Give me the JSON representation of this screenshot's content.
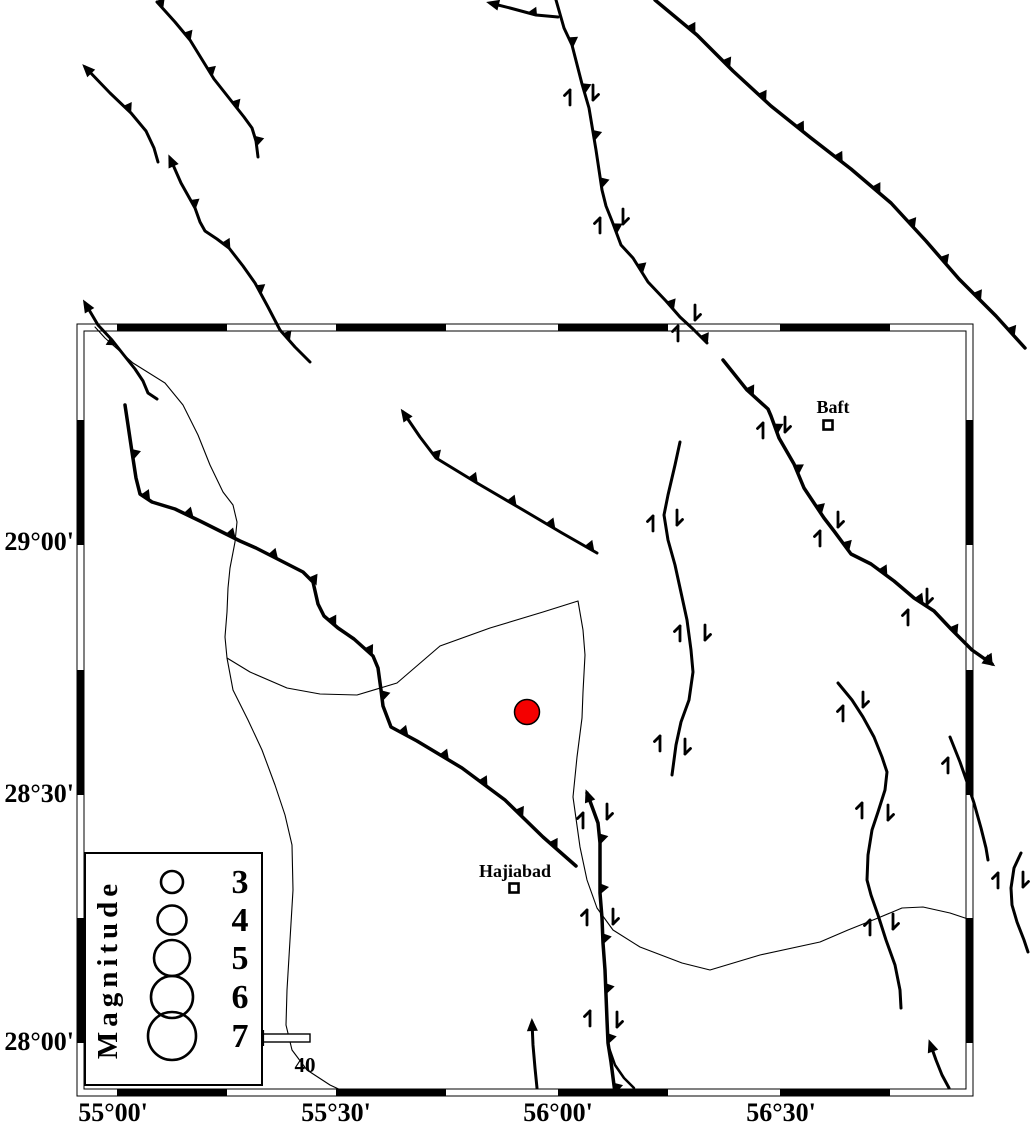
{
  "canvas": {
    "width": 1030,
    "height": 1127,
    "background": "#ffffff",
    "ink": "#000000"
  },
  "frame": {
    "outer": [
      77,
      324,
      973,
      1096
    ],
    "inner": [
      84,
      331,
      966,
      1089
    ],
    "band": 7,
    "x_black_segments": [
      [
        117,
        227
      ],
      [
        336,
        446
      ],
      [
        558,
        668
      ],
      [
        780,
        890
      ]
    ],
    "y_black_segments": [
      [
        420,
        545
      ],
      [
        670,
        795
      ],
      [
        918,
        1043
      ]
    ]
  },
  "axis": {
    "lat_labels": [
      {
        "text": "29°00'",
        "x": 74,
        "y": 550
      },
      {
        "text": "28°30'",
        "x": 74,
        "y": 802
      },
      {
        "text": "28°00'",
        "x": 74,
        "y": 1050
      }
    ],
    "lon_labels": [
      {
        "text": "55°00'",
        "x": 113,
        "y": 1121
      },
      {
        "text": "55°30'",
        "x": 336,
        "y": 1121
      },
      {
        "text": "56°00'",
        "x": 558,
        "y": 1121
      },
      {
        "text": "56°30'",
        "x": 781,
        "y": 1121
      }
    ]
  },
  "cities": [
    {
      "name": "Baft",
      "label_x": 833,
      "label_y": 413,
      "marker_x": 828,
      "marker_y": 425
    },
    {
      "name": "Hajiabad",
      "label_x": 515,
      "label_y": 877,
      "marker_x": 514,
      "marker_y": 888
    }
  ],
  "epicenter": {
    "x": 527,
    "y": 712,
    "r": 12.5,
    "color": "#f40000"
  },
  "legend": {
    "box": [
      85,
      853,
      262,
      1085
    ],
    "title": "Magnitude",
    "title_x": 117,
    "title_y": 969,
    "circle_cx": 172,
    "label_x": 240,
    "entries": [
      {
        "label": "3",
        "cy": 882,
        "r": 11
      },
      {
        "label": "4",
        "cy": 920,
        "r": 14.5
      },
      {
        "label": "5",
        "cy": 958,
        "r": 18
      },
      {
        "label": "6",
        "cy": 997,
        "r": 21
      },
      {
        "label": "7",
        "cy": 1036,
        "r": 24
      }
    ]
  },
  "scalebar": {
    "x1": 263,
    "x2": 310,
    "y": 1034,
    "h": 8,
    "label": "40",
    "label_x": 305,
    "label_y": 1072
  },
  "rivers": [
    {
      "points": [
        [
          95,
          327
        ],
        [
          105,
          338
        ],
        [
          133,
          363
        ],
        [
          165,
          383
        ],
        [
          183,
          405
        ],
        [
          198,
          435
        ],
        [
          210,
          465
        ],
        [
          223,
          492
        ],
        [
          233,
          505
        ],
        [
          237,
          522
        ],
        [
          235,
          542
        ],
        [
          230,
          568
        ],
        [
          228,
          588
        ],
        [
          227,
          612
        ],
        [
          225,
          637
        ],
        [
          227,
          658
        ]
      ]
    },
    {
      "points": [
        [
          227,
          658
        ],
        [
          250,
          672
        ],
        [
          287,
          688
        ],
        [
          320,
          694
        ],
        [
          357,
          695
        ],
        [
          397,
          683
        ],
        [
          440,
          646
        ],
        [
          490,
          628
        ],
        [
          543,
          612
        ],
        [
          578,
          601
        ],
        [
          583,
          630
        ],
        [
          585,
          655
        ],
        [
          583,
          692
        ],
        [
          582,
          718
        ],
        [
          577,
          757
        ],
        [
          573,
          797
        ],
        [
          580,
          847
        ],
        [
          587,
          880
        ],
        [
          597,
          908
        ],
        [
          613,
          930
        ],
        [
          640,
          947
        ],
        [
          682,
          963
        ],
        [
          710,
          970
        ],
        [
          760,
          955
        ],
        [
          820,
          942
        ],
        [
          848,
          930
        ],
        [
          878,
          918
        ],
        [
          902,
          908
        ],
        [
          923,
          907
        ],
        [
          950,
          913
        ],
        [
          968,
          919
        ]
      ]
    },
    {
      "points": [
        [
          227,
          658
        ],
        [
          233,
          690
        ],
        [
          248,
          720
        ],
        [
          262,
          750
        ],
        [
          275,
          785
        ],
        [
          285,
          815
        ],
        [
          292,
          845
        ],
        [
          293,
          890
        ],
        [
          290,
          940
        ],
        [
          287,
          990
        ],
        [
          286,
          1025
        ],
        [
          292,
          1050
        ],
        [
          307,
          1070
        ],
        [
          330,
          1085
        ],
        [
          345,
          1092
        ]
      ]
    }
  ],
  "faults": [
    {
      "id": "f-nw-1",
      "lw": 3,
      "points": [
        [
          157,
          2
        ],
        [
          175,
          22
        ],
        [
          190,
          40
        ],
        [
          214,
          79
        ],
        [
          244,
          117
        ],
        [
          252,
          128
        ],
        [
          256,
          141
        ],
        [
          258,
          157
        ]
      ],
      "teeth": {
        "interval": 42,
        "size": 8.5,
        "side": 1,
        "start": 4
      }
    },
    {
      "id": "f-nw-2",
      "lw": 3,
      "start_arrow": true,
      "points": [
        [
          85,
          67
        ],
        [
          110,
          93
        ],
        [
          131,
          113
        ],
        [
          146,
          131
        ],
        [
          154,
          148
        ],
        [
          158,
          162
        ]
      ],
      "teeth": {
        "interval": 150,
        "size": 8.5,
        "side": 1,
        "start": 60
      }
    },
    {
      "id": "f-nw-3",
      "lw": 3,
      "start_arrow": true,
      "points": [
        [
          170,
          158
        ],
        [
          181,
          183
        ],
        [
          195,
          208
        ],
        [
          200,
          222
        ],
        [
          205,
          231
        ],
        [
          217,
          239
        ],
        [
          229,
          248
        ],
        [
          243,
          266
        ],
        [
          255,
          283
        ],
        [
          268,
          307
        ],
        [
          280,
          330
        ],
        [
          295,
          347
        ],
        [
          310,
          362
        ]
      ],
      "teeth": {
        "interval": 55,
        "size": 8.5,
        "side": 1,
        "start": 52
      }
    },
    {
      "id": "f-frame-w",
      "lw": 3,
      "start_arrow": true,
      "points": [
        [
          85,
          303
        ],
        [
          98,
          325
        ],
        [
          112,
          340
        ],
        [
          123,
          354
        ],
        [
          135,
          369
        ],
        [
          143,
          381
        ],
        [
          148,
          393
        ],
        [
          157,
          399
        ]
      ],
      "teeth": {
        "interval": 90,
        "size": 8,
        "side": -1,
        "start": 48
      }
    },
    {
      "id": "f-central",
      "lw": 3,
      "points": [
        [
          556,
          0
        ],
        [
          564,
          28
        ],
        [
          572,
          45
        ],
        [
          582,
          84
        ],
        [
          589,
          108
        ],
        [
          596,
          150
        ],
        [
          602,
          190
        ],
        [
          606,
          206
        ],
        [
          612,
          221
        ],
        [
          621,
          245
        ],
        [
          633,
          258
        ],
        [
          648,
          282
        ],
        [
          666,
          301
        ],
        [
          680,
          317
        ],
        [
          693,
          329
        ],
        [
          707,
          343
        ]
      ],
      "teeth": {
        "interval": 48,
        "size": 9,
        "side": 1,
        "start": 45
      }
    },
    {
      "id": "f-central-branch",
      "lw": 3,
      "end_arrow": true,
      "points": [
        [
          558,
          17
        ],
        [
          536,
          15
        ],
        [
          510,
          8
        ],
        [
          490,
          3
        ]
      ],
      "teeth": {
        "interval": 120,
        "size": 8,
        "side": -1,
        "start": 26
      }
    },
    {
      "id": "f-ne",
      "lw": 3.5,
      "points": [
        [
          655,
          0
        ],
        [
          697,
          35
        ],
        [
          733,
          71
        ],
        [
          771,
          106
        ],
        [
          811,
          138
        ],
        [
          851,
          169
        ],
        [
          891,
          203
        ],
        [
          926,
          241
        ],
        [
          959,
          279
        ],
        [
          996,
          316
        ],
        [
          1025,
          348
        ]
      ],
      "teeth": {
        "interval": 49,
        "size": 9,
        "side": 1,
        "start": 47
      }
    },
    {
      "id": "f-main-thrust",
      "lw": 3.5,
      "points": [
        [
          125,
          405
        ],
        [
          128,
          425
        ],
        [
          132,
          452
        ],
        [
          136,
          478
        ],
        [
          140,
          494
        ],
        [
          152,
          502
        ],
        [
          175,
          509
        ],
        [
          200,
          521
        ],
        [
          240,
          541
        ],
        [
          256,
          548
        ],
        [
          303,
          572
        ],
        [
          313,
          582
        ],
        [
          318,
          604
        ],
        [
          324,
          616
        ],
        [
          338,
          628
        ],
        [
          354,
          639
        ],
        [
          373,
          656
        ],
        [
          378,
          668
        ],
        [
          381,
          690
        ],
        [
          383,
          706
        ],
        [
          391,
          727
        ],
        [
          417,
          741
        ],
        [
          462,
          768
        ],
        [
          505,
          800
        ],
        [
          543,
          837
        ],
        [
          576,
          866
        ]
      ],
      "teeth": {
        "interval": 47,
        "size": 9,
        "side": 1,
        "start": 50
      }
    },
    {
      "id": "f-mid",
      "lw": 3,
      "start_arrow": true,
      "points": [
        [
          403,
          412
        ],
        [
          420,
          437
        ],
        [
          436,
          458
        ],
        [
          477,
          483
        ],
        [
          518,
          507
        ],
        [
          562,
          533
        ],
        [
          597,
          553
        ]
      ],
      "teeth": {
        "interval": 45,
        "size": 9,
        "side": 1,
        "start": 55
      }
    },
    {
      "id": "f-baft",
      "lw": 3.5,
      "end_arrow": true,
      "points": [
        [
          723,
          360
        ],
        [
          747,
          390
        ],
        [
          768,
          409
        ],
        [
          771,
          416
        ],
        [
          779,
          438
        ],
        [
          794,
          464
        ],
        [
          804,
          488
        ],
        [
          824,
          518
        ],
        [
          834,
          531
        ],
        [
          851,
          554
        ],
        [
          871,
          564
        ],
        [
          894,
          581
        ],
        [
          914,
          598
        ],
        [
          934,
          611
        ],
        [
          951,
          629
        ],
        [
          972,
          650
        ],
        [
          992,
          664
        ]
      ],
      "teeth": {
        "interval": 46,
        "size": 9,
        "side": 1,
        "start": 42
      }
    },
    {
      "id": "f-ns-center",
      "lw": 3,
      "points": [
        [
          680,
          442
        ],
        [
          675,
          465
        ],
        [
          668,
          495
        ],
        [
          664,
          515
        ],
        [
          668,
          540
        ],
        [
          675,
          565
        ],
        [
          682,
          597
        ],
        [
          687,
          620
        ],
        [
          691,
          650
        ],
        [
          693,
          672
        ],
        [
          689,
          700
        ],
        [
          681,
          722
        ],
        [
          676,
          745
        ],
        [
          672,
          775
        ]
      ]
    },
    {
      "id": "f-s-long",
      "lw": 3.5,
      "start_arrow": true,
      "points": [
        [
          587,
          793
        ],
        [
          594,
          812
        ],
        [
          598,
          823
        ],
        [
          600,
          843
        ],
        [
          600,
          868
        ],
        [
          600,
          893
        ],
        [
          602,
          918
        ],
        [
          603,
          943
        ],
        [
          605,
          970
        ],
        [
          606,
          995
        ],
        [
          607,
          1020
        ],
        [
          608,
          1043
        ],
        [
          611,
          1062
        ],
        [
          615,
          1093
        ]
      ],
      "teeth": {
        "interval": 50,
        "size": 9,
        "side": 1,
        "start": 48
      }
    },
    {
      "id": "f-s-branch",
      "lw": 2.5,
      "points": [
        [
          608,
          1045
        ],
        [
          615,
          1065
        ],
        [
          624,
          1078
        ],
        [
          634,
          1088
        ]
      ]
    },
    {
      "id": "f-s-short",
      "lw": 3,
      "start_arrow": true,
      "points": [
        [
          532,
          1022
        ],
        [
          533,
          1045
        ],
        [
          535,
          1068
        ],
        [
          537,
          1088
        ]
      ]
    },
    {
      "id": "f-e-1",
      "lw": 3,
      "points": [
        [
          838,
          683
        ],
        [
          852,
          700
        ],
        [
          863,
          717
        ],
        [
          874,
          737
        ],
        [
          882,
          757
        ],
        [
          887,
          772
        ],
        [
          885,
          790
        ],
        [
          878,
          812
        ],
        [
          872,
          830
        ],
        [
          868,
          855
        ],
        [
          867,
          880
        ],
        [
          871,
          895
        ],
        [
          878,
          915
        ],
        [
          886,
          940
        ],
        [
          895,
          965
        ],
        [
          900,
          990
        ],
        [
          901,
          1008
        ]
      ]
    },
    {
      "id": "f-e-2",
      "lw": 3,
      "points": [
        [
          950,
          737
        ],
        [
          960,
          762
        ],
        [
          967,
          782
        ],
        [
          974,
          803
        ],
        [
          981,
          828
        ],
        [
          986,
          848
        ],
        [
          988,
          860
        ]
      ]
    },
    {
      "id": "f-se-short",
      "lw": 3,
      "start_arrow": true,
      "points": [
        [
          930,
          1043
        ],
        [
          936,
          1060
        ],
        [
          942,
          1075
        ],
        [
          949,
          1088
        ]
      ]
    },
    {
      "id": "f-e-3",
      "lw": 3,
      "points": [
        [
          1021,
          853
        ],
        [
          1014,
          868
        ],
        [
          1011,
          888
        ],
        [
          1012,
          905
        ],
        [
          1017,
          922
        ],
        [
          1024,
          940
        ],
        [
          1028,
          952
        ]
      ]
    }
  ],
  "slip_arrows": [
    {
      "x": 570,
      "y": 97,
      "dir": "up"
    },
    {
      "x": 593,
      "y": 93,
      "dir": "down"
    },
    {
      "x": 600,
      "y": 225,
      "dir": "up"
    },
    {
      "x": 623,
      "y": 217,
      "dir": "down"
    },
    {
      "x": 678,
      "y": 333,
      "dir": "up"
    },
    {
      "x": 695,
      "y": 313,
      "dir": "down"
    },
    {
      "x": 763,
      "y": 430,
      "dir": "up"
    },
    {
      "x": 785,
      "y": 425,
      "dir": "down"
    },
    {
      "x": 820,
      "y": 538,
      "dir": "up"
    },
    {
      "x": 838,
      "y": 520,
      "dir": "down"
    },
    {
      "x": 908,
      "y": 617,
      "dir": "up"
    },
    {
      "x": 927,
      "y": 597,
      "dir": "down"
    },
    {
      "x": 653,
      "y": 523,
      "dir": "up"
    },
    {
      "x": 677,
      "y": 518,
      "dir": "down"
    },
    {
      "x": 680,
      "y": 633,
      "dir": "up"
    },
    {
      "x": 705,
      "y": 633,
      "dir": "down"
    },
    {
      "x": 660,
      "y": 743,
      "dir": "up"
    },
    {
      "x": 685,
      "y": 747,
      "dir": "down"
    },
    {
      "x": 583,
      "y": 820,
      "dir": "up"
    },
    {
      "x": 607,
      "y": 812,
      "dir": "down"
    },
    {
      "x": 587,
      "y": 917,
      "dir": "up"
    },
    {
      "x": 613,
      "y": 917,
      "dir": "down"
    },
    {
      "x": 590,
      "y": 1018,
      "dir": "up"
    },
    {
      "x": 617,
      "y": 1020,
      "dir": "down"
    },
    {
      "x": 843,
      "y": 713,
      "dir": "up"
    },
    {
      "x": 863,
      "y": 700,
      "dir": "down"
    },
    {
      "x": 862,
      "y": 810,
      "dir": "up"
    },
    {
      "x": 888,
      "y": 813,
      "dir": "down"
    },
    {
      "x": 870,
      "y": 927,
      "dir": "up"
    },
    {
      "x": 893,
      "y": 922,
      "dir": "down"
    },
    {
      "x": 948,
      "y": 765,
      "dir": "up"
    },
    {
      "x": 998,
      "y": 880,
      "dir": "up"
    },
    {
      "x": 1023,
      "y": 880,
      "dir": "down"
    }
  ]
}
